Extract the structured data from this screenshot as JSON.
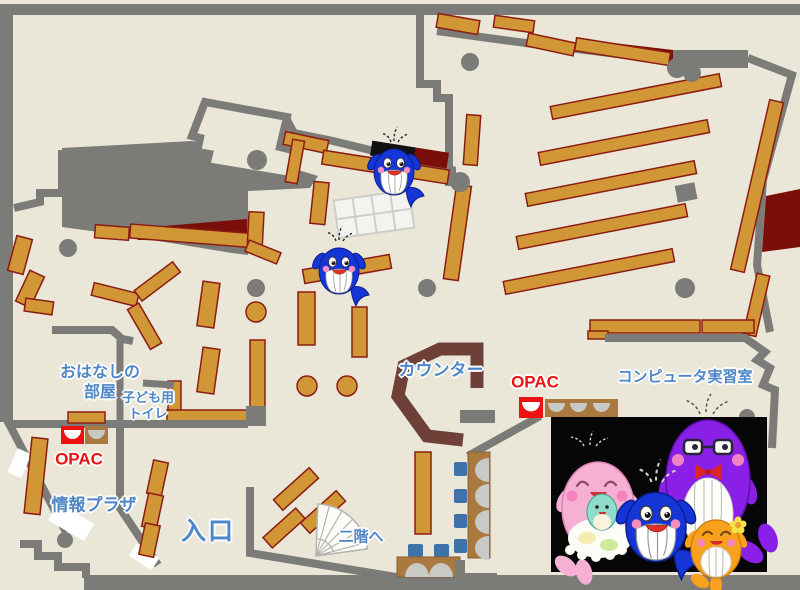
{
  "page": {
    "type": "library-floor-map"
  },
  "map": {
    "labels": {
      "storytime_room": {
        "line1": "おはなしの",
        "line2": "部屋"
      },
      "kids_toilet": {
        "line1": "子ども用",
        "line2": "トイレ"
      },
      "opac_left": "OPAC",
      "opac_right": "OPAC",
      "info_plaza": "情報プラザ",
      "entrance": "入口",
      "counter": "カウンター",
      "computer_room": "コンピュータ実習室",
      "stairs_up": "二階へ"
    },
    "colors": {
      "floor": "#eae7d8",
      "wall": "#7b7b77",
      "shelf": "#d19736",
      "shelf_border": "#8c1c12",
      "dark_red": "#7a0e08",
      "counter": "#6e4038",
      "label_blue": "#4e86c8",
      "label_red": "#ee1111",
      "chair_blue": "#3e73aa",
      "seat_gray": "#c9c9c5",
      "table_brown": "#a9793f",
      "photo_bg": "#060606"
    },
    "mascots": {
      "map_sprites": [
        "blue-whale",
        "blue-whale"
      ],
      "photo_characters": [
        "pink-whale-mother",
        "blue-whale-child",
        "purple-whale-father",
        "orange-whale-child"
      ]
    }
  }
}
